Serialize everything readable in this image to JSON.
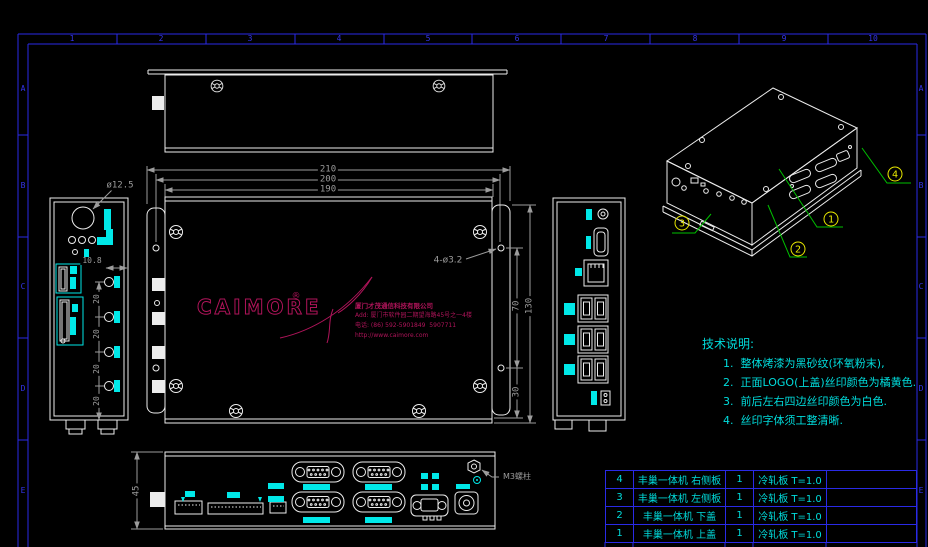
{
  "frame": {
    "zone_numbers": [
      "1",
      "2",
      "3",
      "4",
      "5",
      "6",
      "7",
      "8",
      "9",
      "10"
    ],
    "zone_letters": [
      "A",
      "B",
      "C",
      "D",
      "E"
    ]
  },
  "logo": {
    "brand": "CAIMORE",
    "registered": "®",
    "company": "厦门才茂通信科技有限公司",
    "address": "Add: 厦门市软件园二期望海路45号之一4楼",
    "phone": "电话: (86) 592-5901849  5907711",
    "website": "http://www.caimore.com"
  },
  "dimensions": {
    "d210": "210",
    "d200": "200",
    "d190": "190",
    "d130": "130",
    "d70": "70",
    "d30": "30",
    "d45": "45",
    "pitch20": "20",
    "d108": "10.8",
    "dia125": "ø12.5",
    "holes": "4-ø3.2",
    "screw": "M3螺柱"
  },
  "notes": {
    "title": "技术说明:",
    "items": [
      "1.  整体烤漆为黑砂纹(环氧粉末),",
      "2.  正面LOGO(上盖)丝印颜色为橘黄色.",
      "3.  前后左右四边丝印颜色为白色.",
      "4.  丝印字体须工整清晰."
    ]
  },
  "balloons": [
    "1",
    "2",
    "3",
    "4"
  ],
  "bom_table": {
    "rows": [
      {
        "no": "4",
        "name": "丰巢一体机 右侧板",
        "qty": "1",
        "material": "冷轧板  T=1.0",
        "remark": ""
      },
      {
        "no": "3",
        "name": "丰巢一体机 左侧板",
        "qty": "1",
        "material": "冷轧板  T=1.0",
        "remark": ""
      },
      {
        "no": "2",
        "name": "丰巢一体机 下盖",
        "qty": "1",
        "material": "冷轧板  T=1.0",
        "remark": ""
      },
      {
        "no": "1",
        "name": "丰巢一体机 上盖",
        "qty": "1",
        "material": "冷轧板  T=1.0",
        "remark": ""
      }
    ]
  },
  "colors": {
    "background": "#000000",
    "object_lines": "#ececec",
    "dimension": "#9c9c9c",
    "highlight": "#00e8e8",
    "frame": "#2a2ae6",
    "logo": "#b0145a",
    "leader": "#00c000",
    "balloon": "#e8e800"
  }
}
